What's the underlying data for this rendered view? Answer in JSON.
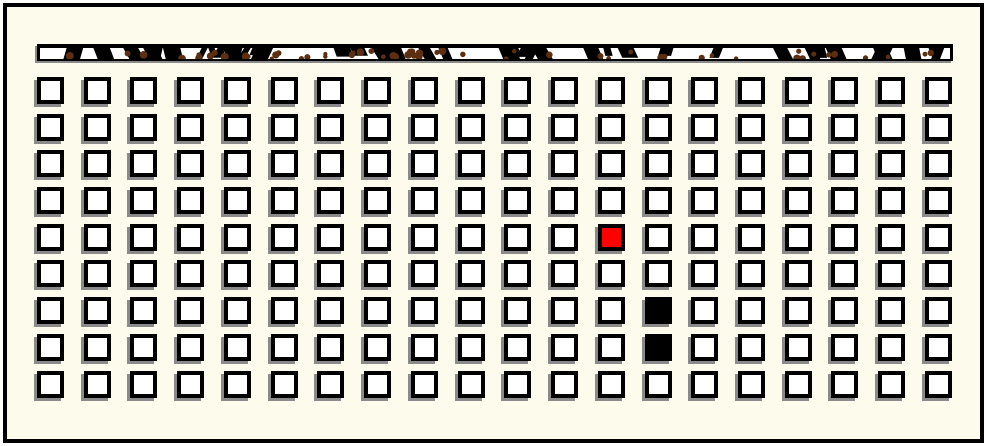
{
  "window": {
    "width": 987,
    "height": 446,
    "outer_background": "#ffffff"
  },
  "board": {
    "background": "#fcfbec",
    "frame_border_color": "#000000",
    "columns": 20,
    "rows": 9,
    "total_cells": 180,
    "cell_size_px": 27,
    "cell_fill": "#ffffff",
    "cell_border_color": "#000000",
    "cell_shadow_color": "#8a8a8a",
    "special_cells": [
      {
        "row": 5,
        "col": 13,
        "state": "red",
        "color": "#ff0000"
      },
      {
        "row": 7,
        "col": 14,
        "state": "black",
        "color": "#000000"
      },
      {
        "row": 8,
        "col": 14,
        "state": "black",
        "color": "#000000"
      }
    ]
  },
  "top_bar": {
    "fill": "#ffffff",
    "border_color": "#000000",
    "slash_color": "#000000",
    "dot_color": "#5c2e12",
    "slash_count": 44,
    "dot_count": 58,
    "seed": 7
  }
}
